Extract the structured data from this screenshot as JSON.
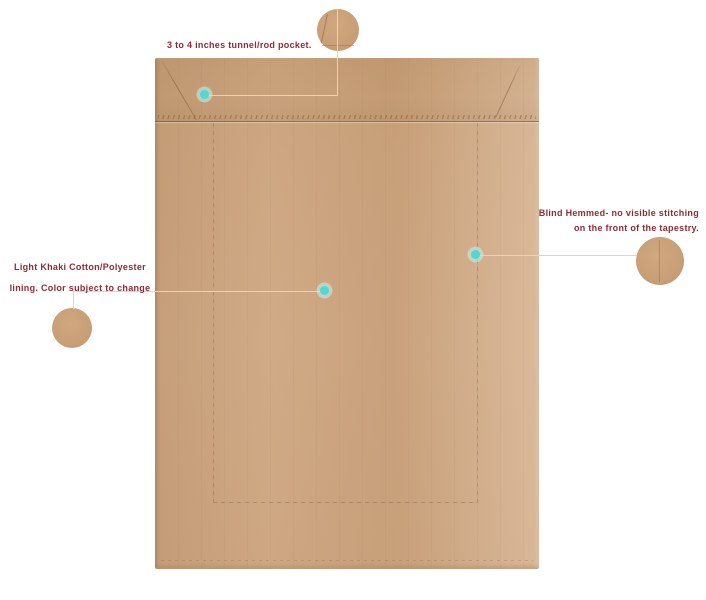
{
  "product": {
    "subject": "tapestry back with khaki lining"
  },
  "colors": {
    "background": "#ffffff",
    "fabric": "#cba27b",
    "fabric_pocket_shade": "#c69c73",
    "seam_line": "#7d5f3e",
    "annotation_text": "#8e2b35",
    "leader_line": "#ace9e5",
    "marker_core": "#4fd8d4",
    "marker_halo": "#bdeeeb"
  },
  "annotations": {
    "rod_pocket": {
      "text": "3 to 4 inches tunnel/rod pocket."
    },
    "blind_hem": {
      "line1": "Blind Hemmed- no visible stitching",
      "line2": "on the front of the tapestry."
    },
    "lining": {
      "line1": "Light Khaki Cotton/Polyester",
      "line2": "lining. Color subject to change"
    }
  }
}
